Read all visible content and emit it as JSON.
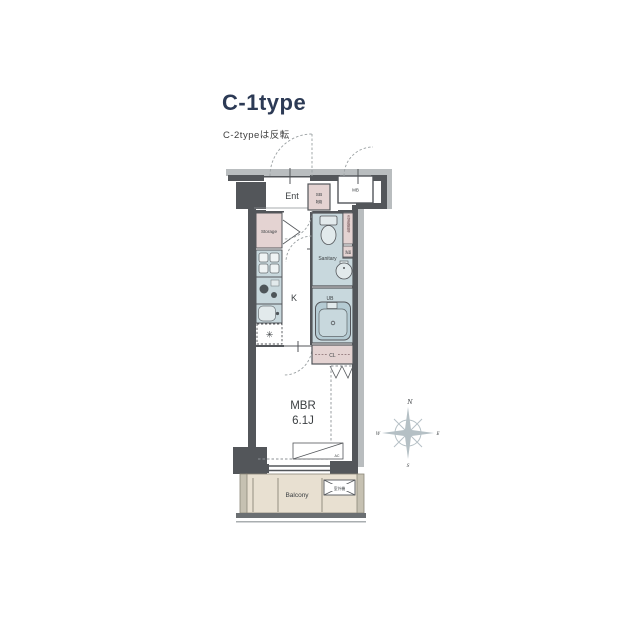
{
  "header": {
    "title": "C-1type",
    "subtitle": "C-2typeは反転"
  },
  "plan": {
    "entrance": {
      "label": "Ent"
    },
    "shoe_box": {
      "label": "SB",
      "note": "靴箱"
    },
    "meter_box": {
      "label": "MB"
    },
    "storage": {
      "label": "Storage"
    },
    "kitchen": {
      "label": "K"
    },
    "sanitary": {
      "label": "Sanitary"
    },
    "washer_space": {
      "label": "洗濯機置場"
    },
    "washstand": {
      "label": "洗面"
    },
    "unit_bath": {
      "label": "UB"
    },
    "closet": {
      "label": "CL"
    },
    "bedroom": {
      "label": "MBR",
      "size": "6.1J"
    },
    "aircon": {
      "label": "AC"
    },
    "balcony": {
      "label": "Balcony"
    },
    "outdoor_unit": {
      "label": "室外機"
    },
    "compass": {
      "north": "N",
      "east": "E",
      "south": "S",
      "west": "W"
    }
  },
  "colors": {
    "wall": "#53565a",
    "outer_gray": "#b9bdbf",
    "pink": "#e4d3d2",
    "blue": "#c8d8dd",
    "blue_dark": "#b5cbd3",
    "fixture_light": "#e2eaec",
    "beige": "#e8e0d1",
    "balcony_wall": "#c6c1b2",
    "title_navy": "#2c3a55",
    "compass_gray": "#b5c0c5"
  }
}
